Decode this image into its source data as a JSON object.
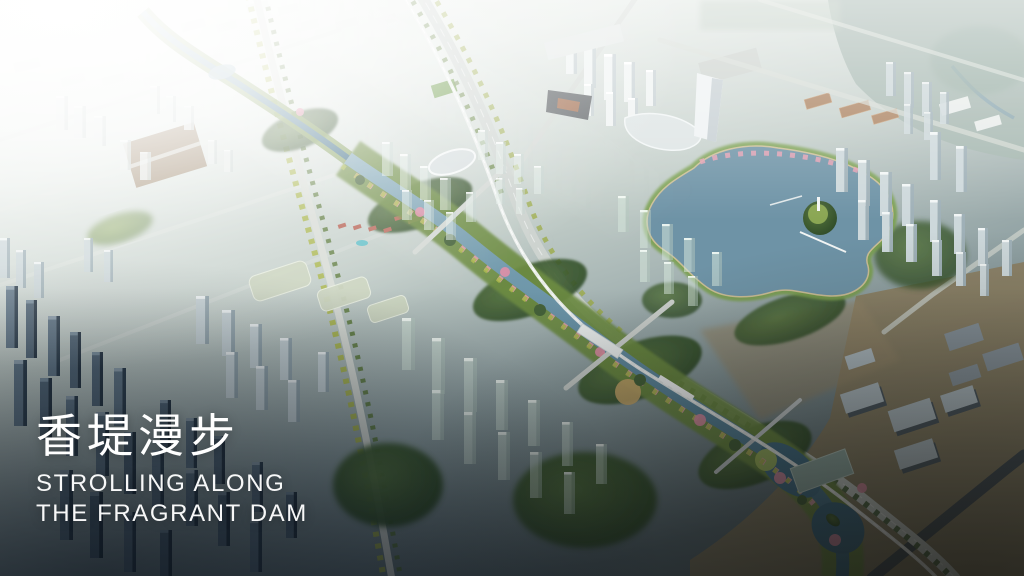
{
  "slide": {
    "title_cn": "香堤漫步",
    "subtitle_line1": "STROLLING ALONG",
    "subtitle_line2": "THE FRAGRANT DAM"
  },
  "scene": {
    "alt": "Aerial masterplan rendering of a riverside city corridor with lake, parks and towers",
    "colors": {
      "river_water": "#3c6c85",
      "lake_water": "#6e93a6",
      "park_green": "#2e4a28",
      "canopy_yellow_green": "#a9b84a",
      "blossom_pink": "#e59fb2",
      "haze_white": "#f8faf6",
      "shadow_slate": "#2f404f",
      "industrial_tan": "#8c7f63",
      "title_text": "#ffffff"
    }
  }
}
